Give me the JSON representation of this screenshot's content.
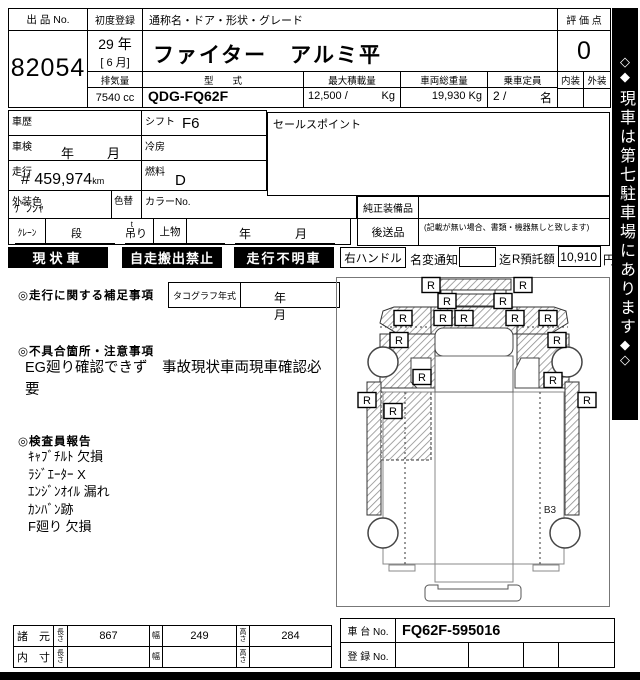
{
  "header": {
    "lot_label": "出 品 No.",
    "lot_no": "82054",
    "first_reg_label": "初度登録",
    "first_reg_year": "29 年",
    "first_reg_month": "[ 6 月]",
    "name_label": "通称名・ドア・形状・グレード",
    "name_value": "ファイター　アルミ平",
    "displacement_label": "排気量",
    "displacement_value": "7540 cc",
    "model_label": "型　　式",
    "model_value": "QDG-FQ62F",
    "max_load_label": "最大積載量",
    "max_load_value": "12,500 /",
    "max_load_unit": "Kg",
    "gross_weight_label": "車両総重量",
    "gross_weight_value": "19,930 Kg",
    "capacity_label": "乗車定員",
    "capacity_value": "2 /",
    "capacity_unit": "名",
    "score_label": "評 価 点",
    "score_value": "0",
    "interior_label": "内装",
    "exterior_label": "外装"
  },
  "banner": {
    "top_diamond_1": "◇",
    "top_diamond_2": "◆",
    "text": "現車は第七駐車場にあります",
    "bottom_diamond_1": "◆",
    "bottom_diamond_2": "◇"
  },
  "info": {
    "history_label": "車歴",
    "shift_label": "シフト",
    "shift_value": "F6",
    "inspection_label": "車検",
    "inspection_value": "年　月",
    "ac_label": "冷房",
    "mileage_label": "走行",
    "mileage_prefix": "#",
    "mileage_value": "459,974",
    "mileage_unit": "km",
    "fuel_label": "燃料",
    "fuel_value": "D",
    "color_label": "外装色",
    "color_value": "ｹﾞﾝｼｬ",
    "color_change_label": "色替",
    "color_no_label": "カラーNo.",
    "crane_label": "ｸﾚｰﾝ",
    "crane_dan": "段",
    "crane_t": "t",
    "crane_tsuri": "吊り",
    "upper_body_label": "上物",
    "upper_body_value": "年　月",
    "sales_point_label": "セールスポイント",
    "oem_equipment_label": "純正装備品",
    "later_items_label": "後送品",
    "later_items_note": "(記載が無い場合、書類・機器無しと致します)"
  },
  "badges": [
    "現状車",
    "自走搬出禁止",
    "走行不明車"
  ],
  "handle_row": {
    "handle_label": "右ハンドル",
    "name_change_label": "名変通知",
    "until_label": "迄",
    "deposit_label": "R預託額",
    "deposit_value": "10,910",
    "deposit_unit": "円"
  },
  "notes": {
    "mileage_note_label": "◎走行に関する補足事項",
    "tacho_label": "タコグラフ年式",
    "tacho_value": "年　月",
    "defect_label": "◎不具合箇所・注意事項",
    "defect_lines": [
      "EG廻り確認できず　事故現状車両現車確認必",
      "要"
    ],
    "inspector_label": "◎検査員報告",
    "inspector_lines": [
      "ｷｬﾌﾞﾁﾙﾄ 欠損",
      "ﾗｼﾞｴｰﾀｰ X",
      "ｴﾝｼﾞﾝｵｲﾙ 漏れ",
      "ｶﾝﾊﾞﾝ跡",
      "F廻り 欠損"
    ]
  },
  "diagram": {
    "zone_label": "B3",
    "mark_symbol": "R",
    "marks": [
      {
        "x": 94,
        "y": 7
      },
      {
        "x": 186,
        "y": 7
      },
      {
        "x": 110,
        "y": 23
      },
      {
        "x": 166,
        "y": 23
      },
      {
        "x": 66,
        "y": 40
      },
      {
        "x": 106,
        "y": 40
      },
      {
        "x": 127,
        "y": 40
      },
      {
        "x": 178,
        "y": 40
      },
      {
        "x": 211,
        "y": 40
      },
      {
        "x": 62,
        "y": 62
      },
      {
        "x": 220,
        "y": 62
      },
      {
        "x": 85,
        "y": 99
      },
      {
        "x": 216,
        "y": 102
      },
      {
        "x": 30,
        "y": 122
      },
      {
        "x": 56,
        "y": 133
      },
      {
        "x": 250,
        "y": 122
      }
    ]
  },
  "footer": {
    "spec_label": "諸　元",
    "inner_label": "内　寸",
    "length_label": "長さ",
    "width_label": "幅",
    "height_label": "高さ",
    "spec_length": "867",
    "spec_width": "249",
    "spec_height": "284",
    "chassis_label": "車 台 No.",
    "chassis_value": "FQ62F-595016",
    "reg_label": "登 録 No."
  }
}
